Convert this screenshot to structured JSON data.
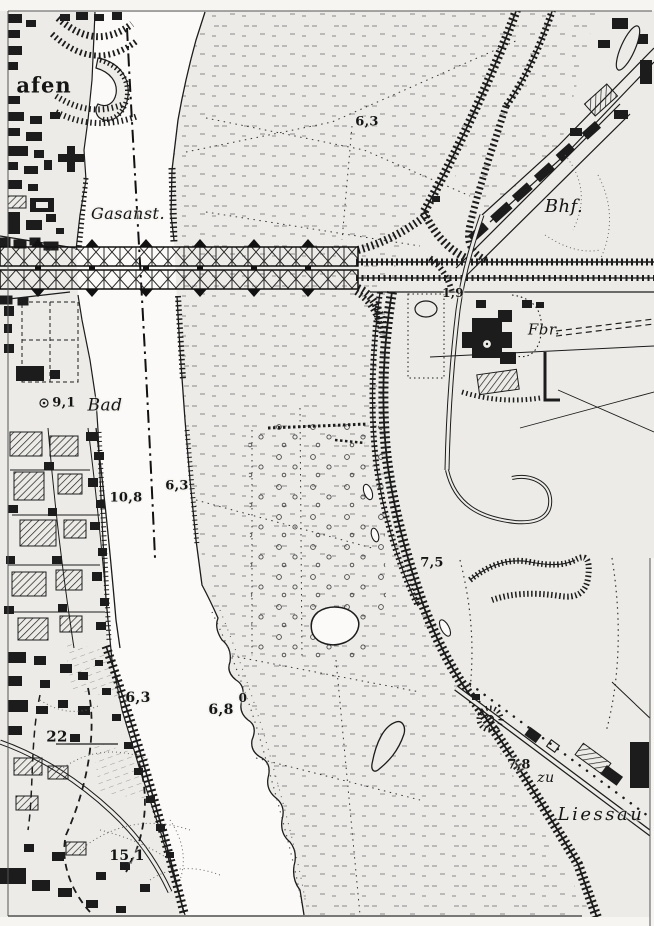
{
  "map": {
    "kind": "scanned historical topographic map sheet (river, bridge, railways, town)",
    "colors": {
      "paper": "#ecebe7",
      "ink": "#1c1c1c",
      "water": "#fbfaf8",
      "margin": "#f6f5f2"
    },
    "labels": {
      "places": [
        {
          "name": "label-hafen",
          "text": "afen",
          "x": 44,
          "y": 85,
          "cls": "place-roman",
          "size": 21
        },
        {
          "name": "label-gasanst",
          "text": "Gasanst.",
          "x": 128,
          "y": 214,
          "cls": "place",
          "size": 16
        },
        {
          "name": "label-bhf",
          "text": "Bhf.",
          "x": 564,
          "y": 207,
          "cls": "place",
          "size": 18
        },
        {
          "name": "label-bad",
          "text": "Bad",
          "x": 105,
          "y": 406,
          "cls": "place",
          "size": 17
        },
        {
          "name": "label-fbr",
          "text": "Fbr.",
          "x": 544,
          "y": 330,
          "cls": "place",
          "size": 15
        },
        {
          "name": "label-zu",
          "text": "zu",
          "x": 546,
          "y": 778,
          "cls": "place",
          "size": 14
        },
        {
          "name": "label-liessau",
          "text": "Liessau",
          "x": 601,
          "y": 815,
          "cls": "place wide",
          "size": 18
        }
      ],
      "spot_heights": [
        {
          "name": "height-6-3-north",
          "text": "6,3",
          "x": 367,
          "y": 122,
          "size": 13
        },
        {
          "name": "height-1-9",
          "text": "1,9",
          "x": 453,
          "y": 293,
          "size": 12
        },
        {
          "name": "height-9-1",
          "text": "9,1",
          "x": 64,
          "y": 403,
          "size": 13
        },
        {
          "name": "height-10-8",
          "text": "10,8",
          "x": 126,
          "y": 498,
          "size": 13
        },
        {
          "name": "height-6-3-river",
          "text": "6,3",
          "x": 177,
          "y": 486,
          "size": 13
        },
        {
          "name": "height-7-5",
          "text": "7,5",
          "x": 432,
          "y": 563,
          "size": 13
        },
        {
          "name": "height-6-8",
          "text": "6,8",
          "x": 221,
          "y": 710,
          "size": 14
        },
        {
          "name": "height-0-gauge",
          "text": "0",
          "x": 243,
          "y": 698,
          "size": 12
        },
        {
          "name": "height-6-3-west",
          "text": "6,3",
          "x": 138,
          "y": 698,
          "size": 14
        },
        {
          "name": "height-22",
          "text": "22",
          "x": 57,
          "y": 737,
          "size": 15
        },
        {
          "name": "height-15-1",
          "text": "15,1",
          "x": 127,
          "y": 856,
          "size": 14
        },
        {
          "name": "height-7-8",
          "text": "7,8",
          "x": 519,
          "y": 765,
          "size": 13
        }
      ]
    }
  }
}
